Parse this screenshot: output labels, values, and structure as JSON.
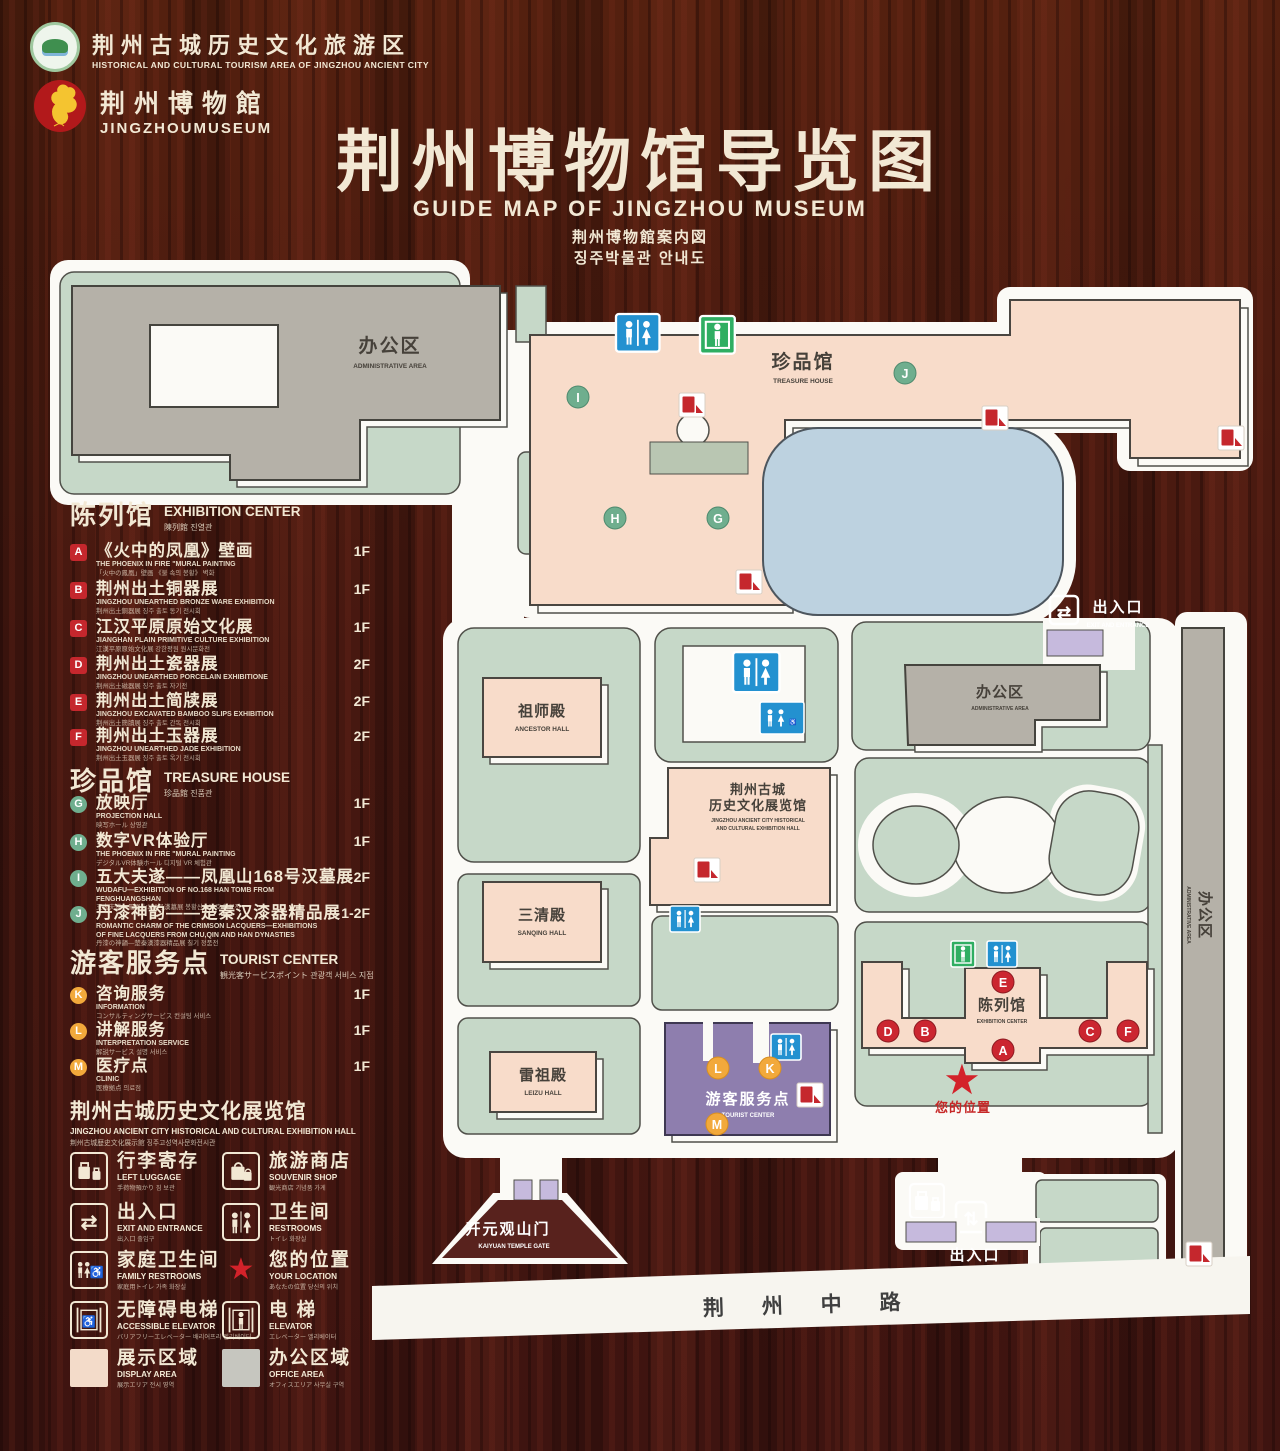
{
  "colors": {
    "wood": "#46170f",
    "plot_green": "#c6d8c8",
    "building_gray": "#b5b1a8",
    "building_pink": "#f8dcca",
    "pond_blue": "#bdd2e0",
    "tourist_purple": "#8e7eae",
    "gate_purple": "#c6badd",
    "marker_red": "#c5272d",
    "marker_green": "#6fae8e",
    "marker_orange": "#f2a93b",
    "icon_blue": "#2391d0",
    "icon_green": "#2fae62",
    "text_cream": "#f2e8d4"
  },
  "header": {
    "tourism_logo": {
      "zh": "荆州古城历史文化旅游区",
      "en": "HISTORICAL AND CULTURAL TOURISM AREA OF JINGZHOU ANCIENT CITY"
    },
    "museum_logo": {
      "zh": "荆州博物館",
      "en": "JINGZHOUMUSEUM"
    },
    "title_zh": "荆州博物馆导览图",
    "title_en": "GUIDE MAP OF JINGZHOU MUSEUM",
    "title_ja": "荆州博物館案内図",
    "title_ko": "징주박물관 안내도"
  },
  "letters": {
    "A": "A",
    "B": "B",
    "C": "C",
    "D": "D",
    "E": "E",
    "F": "F",
    "G": "G",
    "H": "H",
    "I": "I",
    "J": "J",
    "K": "K",
    "L": "L",
    "M": "M"
  },
  "sidebar": {
    "sections": [
      {
        "zh": "陈列馆",
        "en": "EXHIBITION CENTER",
        "sub": "陳列館  진열관",
        "items": [
          {
            "letter": "A",
            "zh": "《火中的凤凰》壁画",
            "en": "THE PHOENIX IN FIRE \"MURAL PAINTING",
            "sub": "「火中の鳳凰」壁画 《불 속의 봉황》 벽화",
            "floor": "1F"
          },
          {
            "letter": "B",
            "zh": "荆州出土铜器展",
            "en": "JINGZHOU UNEARTHED BRONZE WARE EXHIBITION",
            "sub": "荆州出土銅器展  징주 출토 동기 전시회",
            "floor": "1F"
          },
          {
            "letter": "C",
            "zh": "江汉平原原始文化展",
            "en": "JIANGHAN PLAIN PRIMITIVE CULTURE EXHIBITION",
            "sub": "江漢平原原始文化展  강한평원 원시문화전",
            "floor": "1F"
          },
          {
            "letter": "D",
            "zh": "荆州出土瓷器展",
            "en": "JINGZHOU UNEARTHED PORCELAIN EXHIBITIONE",
            "sub": "荆州出土磁器展  징주 출토 자기전",
            "floor": "2F"
          },
          {
            "letter": "E",
            "zh": "荆州出土简牍展",
            "en": "JINGZHOU EXCAVATED BAMBOO SLIPS EXHIBITION",
            "sub": "荆州出土簡牘展  징주 출토 간독 전시회",
            "floor": "2F"
          },
          {
            "letter": "F",
            "zh": "荆州出土玉器展",
            "en": "JINGZHOU UNEARTHED JADE EXHIBITION",
            "sub": "荆州出土玉器展  징주 출토 옥기 전시회",
            "floor": "2F"
          }
        ]
      },
      {
        "zh": "珍品馆",
        "en": "TREASURE HOUSE",
        "sub": "珍品館  진품관",
        "items": [
          {
            "letter": "G",
            "zh": "放映厅",
            "en": "PROJECTION HALL",
            "sub": "映写ホール  상영관",
            "floor": "1F"
          },
          {
            "letter": "H",
            "zh": "数字VR体验厅",
            "en": "THE PHOENIX IN FIRE \"MURAL PAINTING",
            "sub": "デジタルVR体験ホール  디지털 VR 체험관",
            "floor": "1F"
          },
          {
            "letter": "I",
            "zh": "五大夫遂——凤凰山168号汉墓展",
            "en": "WUDAFU—EXHIBITION OF NO.168 HAN TOMB FROM FENGHUANGSHAN",
            "sub": "五大夫遂—鳳凰山168号漢墓展  봉황산 168호 한묘전",
            "floor": "2F"
          },
          {
            "letter": "J",
            "zh": "丹漆神韵——楚秦汉漆器精品展",
            "en": "ROMANTIC CHARM OF THE CRIMSON LACQUERS—EXHIBITIONS OF FINE LACQUERS FROM CHU,QIN AND HAN DYNASTIES",
            "sub": "丹漆の神韻—楚秦漢漆器精品展  칠기 정품전",
            "floor": "1-2F"
          }
        ]
      },
      {
        "zh": "游客服务点",
        "en": "TOURIST CENTER",
        "sub": "観光客サービスポイント  관광객 서비스 지점",
        "items": [
          {
            "letter": "K",
            "zh": "咨询服务",
            "en": "INFORMATION",
            "sub": "コンサルティングサービス  컨설팅 서비스",
            "floor": "1F"
          },
          {
            "letter": "L",
            "zh": "讲解服务",
            "en": "INTERPRETATION SERVICE",
            "sub": "解説サービス  설명 서비스",
            "floor": "1F"
          },
          {
            "letter": "M",
            "zh": "医疗点",
            "en": "CLINIC",
            "sub": "医療拠点  의료점",
            "floor": "1F"
          }
        ]
      }
    ],
    "hall": {
      "zh": "荆州古城历史文化展览馆",
      "en": "JINGZHOU ANCIENT CITY HISTORICAL AND CULTURAL EXHIBITION HALL",
      "sub": "荆州古城歴史文化展示館   징주고성역사문화전시관"
    },
    "legend": [
      {
        "zh": "行李寄存",
        "en": "LEFT LUGGAGE",
        "sub": "手荷物預かり  짐 보관"
      },
      {
        "zh": "旅游商店",
        "en": "SOUVENIR SHOP",
        "sub": "観光商店  기념품 가게"
      },
      {
        "zh": "出入口",
        "en": "EXIT AND ENTRANCE",
        "sub": "出入口  출입구"
      },
      {
        "zh": "卫生间",
        "en": "RESTROOMS",
        "sub": "トイレ  화장실"
      },
      {
        "zh": "家庭卫生间",
        "en": "FAMILY RESTROOMS",
        "sub": "家庭用トイレ  가족 화장실"
      },
      {
        "zh": "您的位置",
        "en": "YOUR LOCATION",
        "sub": "あなたの位置  당신의 위치"
      },
      {
        "zh": "无障碍电梯",
        "en": "ACCESSIBLE ELEVATOR",
        "sub": "バリアフリーエレベーター  배리어프리 엘리베이터"
      },
      {
        "zh": "电  梯",
        "en": "ELEVATOR",
        "sub": "エレベーター  엘리베이터"
      },
      {
        "zh": "展示区域",
        "en": "DISPLAY AREA",
        "sub": "展示エリア  전시 영역"
      },
      {
        "zh": "办公区域",
        "en": "OFFICE AREA",
        "sub": "オフィスエリア  사무실 구역"
      }
    ]
  },
  "map": {
    "labels": {
      "office": {
        "zh": "办公区",
        "en": "ADMINISTRATIVE AREA"
      },
      "treasure": {
        "zh": "珍品馆",
        "en": "TREASURE HOUSE"
      },
      "ancestor": {
        "zh": "祖师殿",
        "en": "ANCESTOR HALL"
      },
      "sanqing": {
        "zh": "三清殿",
        "en": "SANQING HALL"
      },
      "leizu": {
        "zh": "雷祖殿",
        "en": "LEIZU HALL"
      },
      "hall": {
        "zh1": "荆州古城",
        "zh2": "历史文化展览馆",
        "en1": "JINGZHOU ANCIENT CITY HISTORICAL",
        "en2": "AND CULTURAL EXHIBITION HALL"
      },
      "tourist": {
        "zh": "游客服务点",
        "en": "TOURIST CENTER"
      },
      "exhibition": {
        "zh": "陈列馆",
        "en": "EXHIBITION CENTER"
      },
      "entrance": {
        "zh": "出入口",
        "en": "EXIT AND ENTRANCE"
      },
      "gate": {
        "zh": "开元观山门",
        "en": "KAIYUAN TEMPLE GATE"
      },
      "road": "荆 州 中 路",
      "your_location": "您的位置"
    }
  }
}
